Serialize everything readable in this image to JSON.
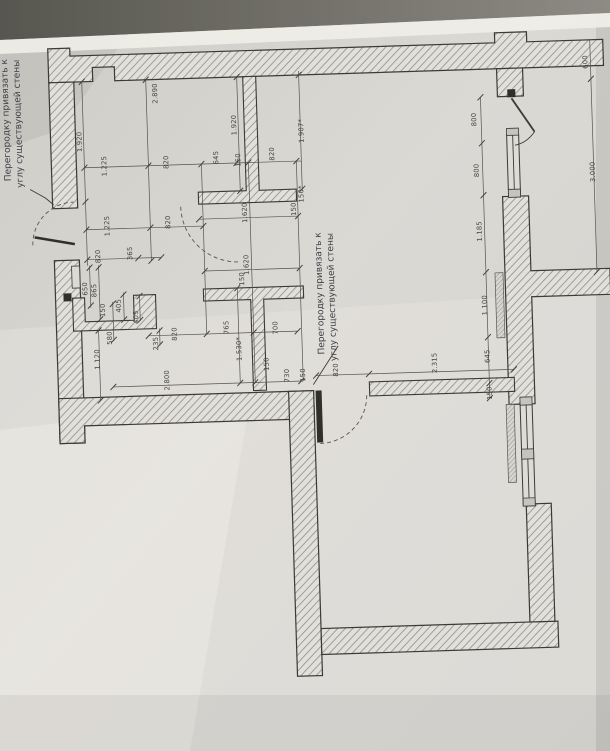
{
  "annotations": {
    "note_left": {
      "line1": "Перегородку привязать к",
      "line2": "углу существующей стены"
    },
    "note_middle": {
      "line1": "Перегородку привязать к",
      "line2": "углу существующей стены"
    }
  },
  "dimensions": [
    {
      "t": "2.890",
      "x": 163,
      "y": 98
    },
    {
      "t": "1.920",
      "x": 86,
      "y": 144
    },
    {
      "t": "1.225",
      "x": 110,
      "y": 169
    },
    {
      "t": "820",
      "x": 172,
      "y": 167
    },
    {
      "t": "645",
      "x": 222,
      "y": 164
    },
    {
      "t": "150",
      "x": 244,
      "y": 167
    },
    {
      "t": "820",
      "x": 278,
      "y": 162
    },
    {
      "t": "1.920",
      "x": 241,
      "y": 132
    },
    {
      "t": "1.907*",
      "x": 308,
      "y": 140
    },
    {
      "t": "1.225",
      "x": 111,
      "y": 229
    },
    {
      "t": "820",
      "x": 172,
      "y": 227
    },
    {
      "t": "1.620",
      "x": 249,
      "y": 220
    },
    {
      "t": "150",
      "x": 298,
      "y": 218
    },
    {
      "t": "150*",
      "x": 306,
      "y": 203
    },
    {
      "t": "820",
      "x": 101,
      "y": 259
    },
    {
      "t": "365",
      "x": 133,
      "y": 257
    },
    {
      "t": "650",
      "x": 87,
      "y": 291
    },
    {
      "t": "865",
      "x": 96,
      "y": 293
    },
    {
      "t": "150",
      "x": 104,
      "y": 313
    },
    {
      "t": "405",
      "x": 120,
      "y": 309
    },
    {
      "t": "405",
      "x": 137,
      "y": 321
    },
    {
      "t": "580",
      "x": 110,
      "y": 341
    },
    {
      "t": "235",
      "x": 156,
      "y": 348
    },
    {
      "t": "1.120",
      "x": 97,
      "y": 362
    },
    {
      "t": "2.800",
      "x": 166,
      "y": 385
    },
    {
      "t": "820",
      "x": 175,
      "y": 339
    },
    {
      "t": "765",
      "x": 227,
      "y": 334
    },
    {
      "t": "700",
      "x": 276,
      "y": 336
    },
    {
      "t": "1.530*",
      "x": 239,
      "y": 356
    },
    {
      "t": "1.620",
      "x": 249,
      "y": 272
    },
    {
      "t": "150",
      "x": 244,
      "y": 286
    },
    {
      "t": "150",
      "x": 266,
      "y": 372
    },
    {
      "t": "730",
      "x": 286,
      "y": 384
    },
    {
      "t": "150",
      "x": 302,
      "y": 384
    },
    {
      "t": "820",
      "x": 335,
      "y": 380
    },
    {
      "t": "2.315",
      "x": 434,
      "y": 376
    },
    {
      "t": "1.100",
      "x": 486,
      "y": 320
    },
    {
      "t": "645",
      "x": 487,
      "y": 371
    },
    {
      "t": "150",
      "x": 488,
      "y": 408
    },
    {
      "t": "1.185",
      "x": 483,
      "y": 246
    },
    {
      "t": "800",
      "x": 481,
      "y": 134
    },
    {
      "t": "800",
      "x": 482,
      "y": 185
    },
    {
      "t": "600",
      "x": 594,
      "y": 80
    },
    {
      "t": "3.000",
      "x": 598,
      "y": 190
    }
  ],
  "colors": {
    "paper": "#d9d7d2",
    "background_band": "#5f5e57",
    "wall_hatch": "#8e8e88",
    "line": "#3b3b36"
  }
}
